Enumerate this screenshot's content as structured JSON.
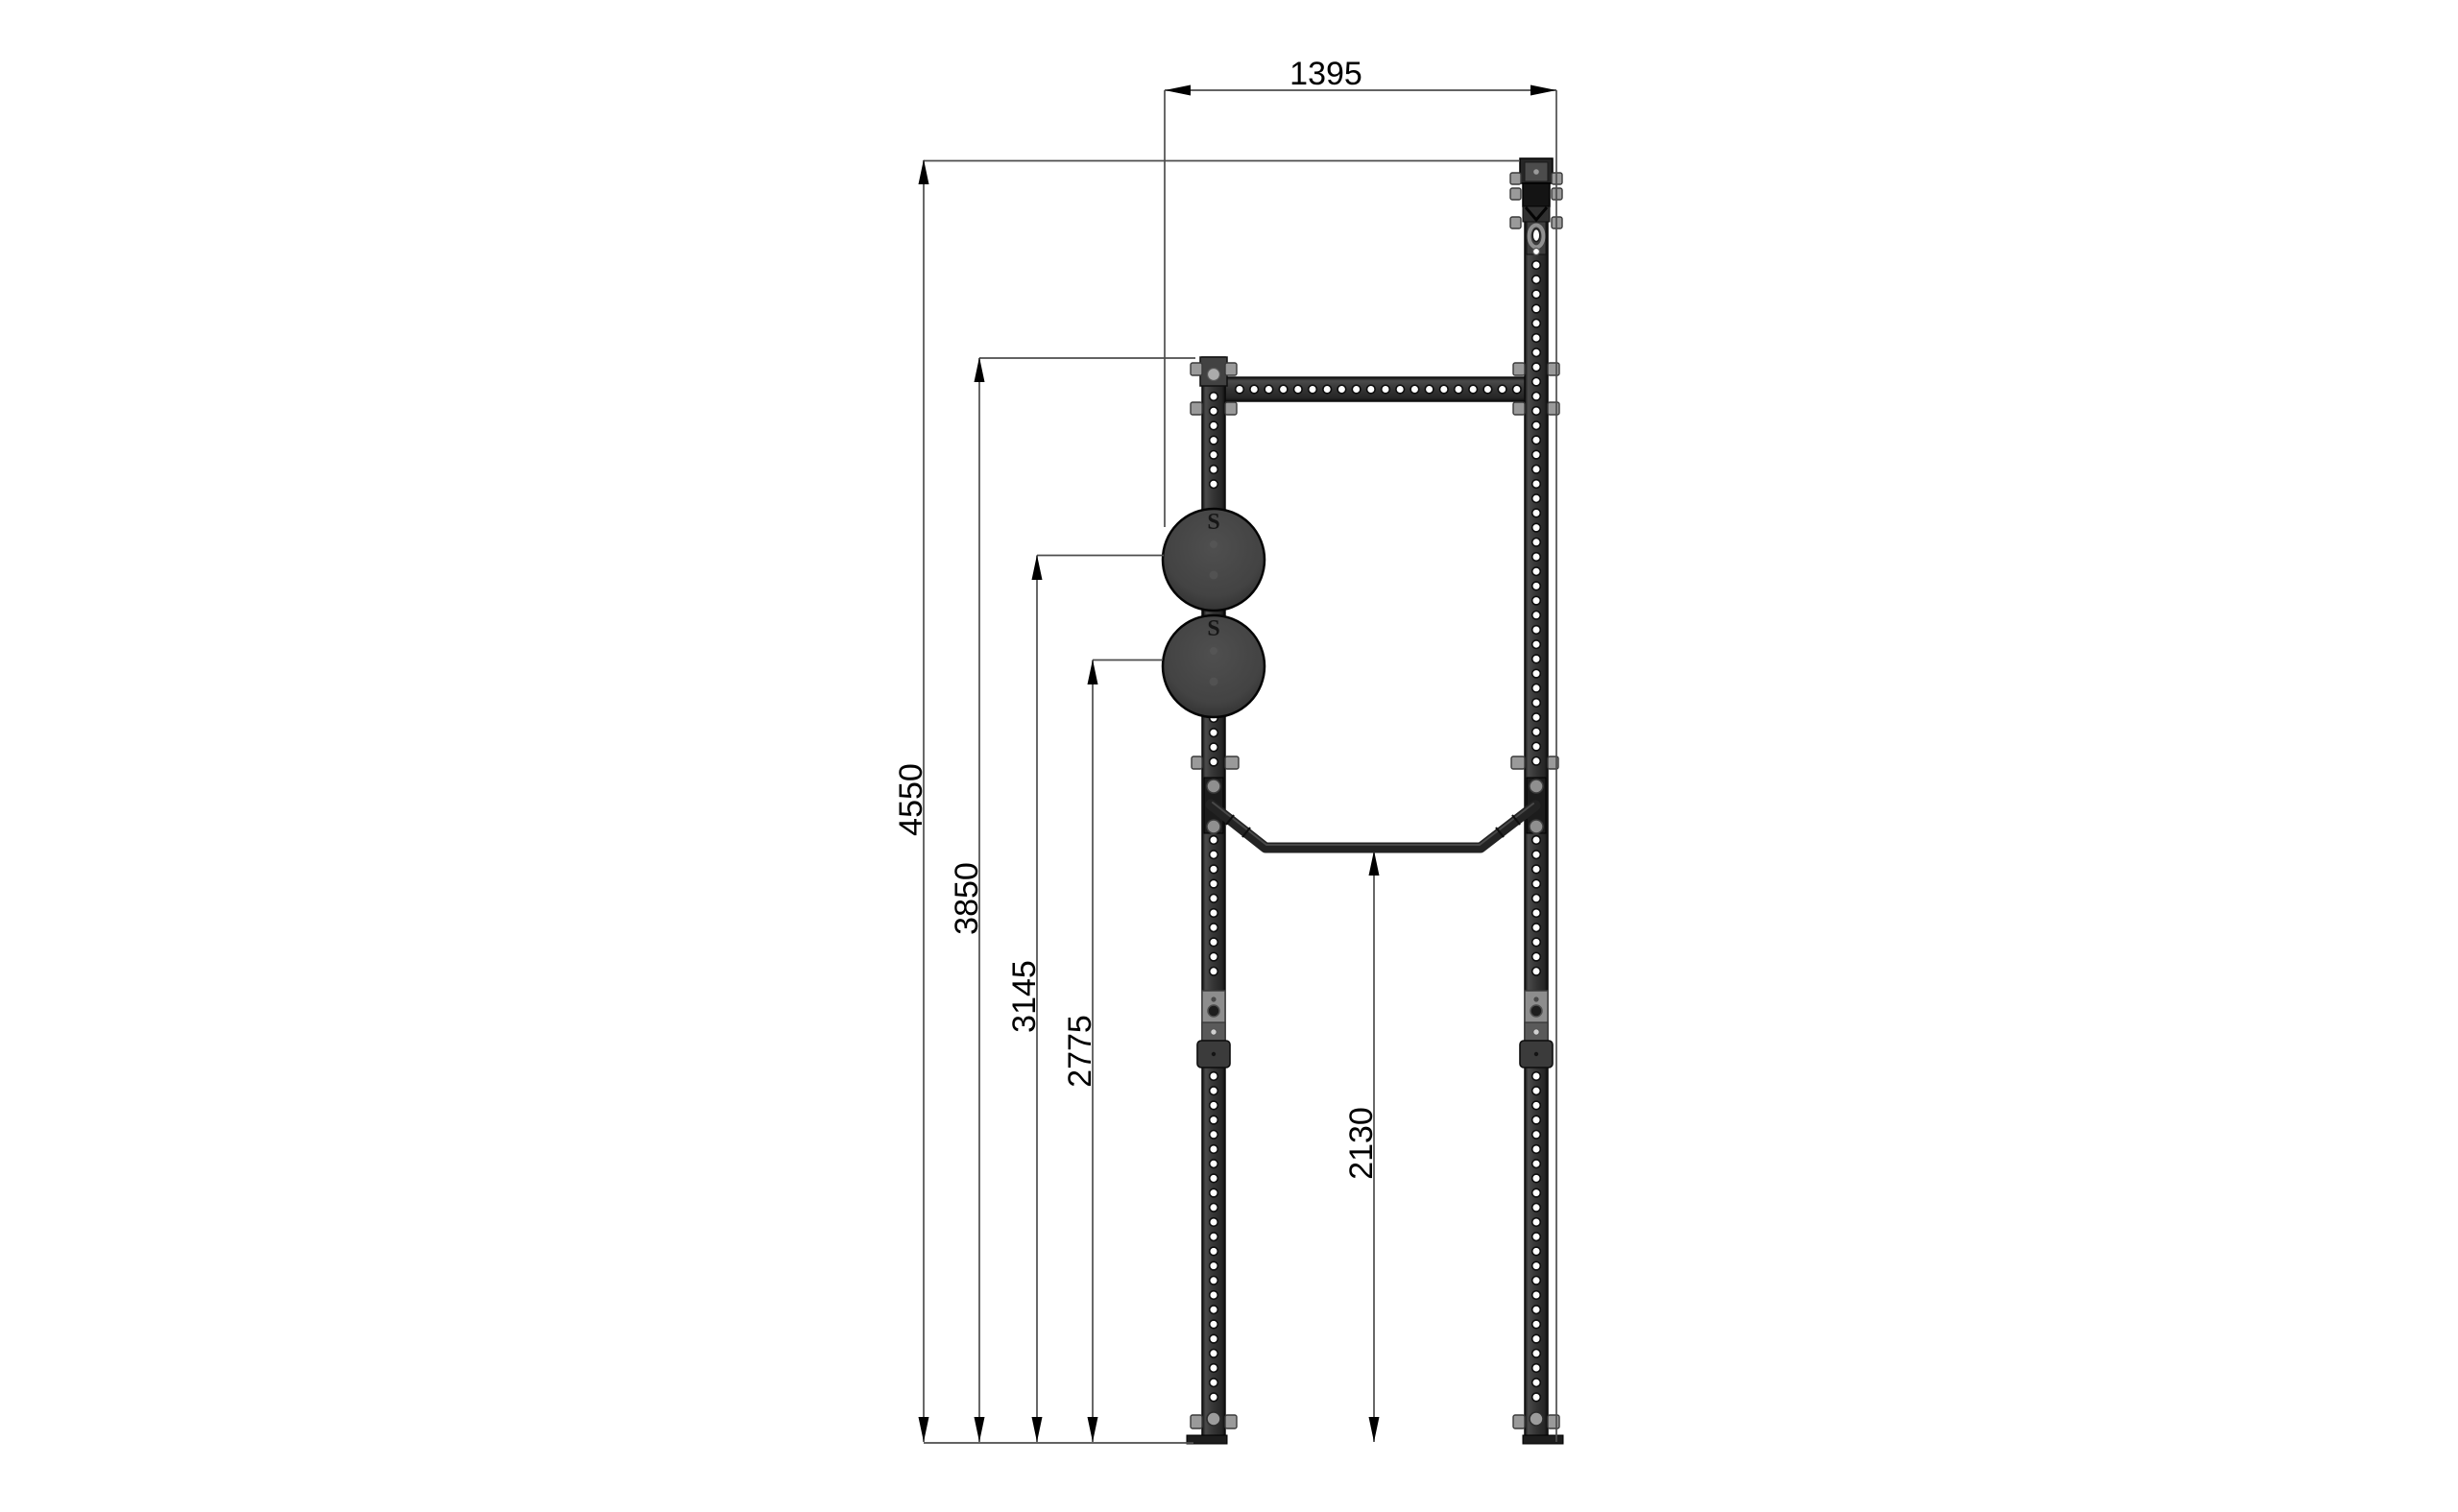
{
  "drawing": {
    "type": "technical-dimension-drawing",
    "subject": "free-standing rig side view with cannonball grips and pull-up bar",
    "background": "#ffffff",
    "colors": {
      "dimension_line": "#4d4d4d",
      "text": "#000000",
      "steel_dark": "#2e2e2e",
      "steel_light": "#8d8d8d",
      "ball_fill": "#454545",
      "hole_fill": "#ffffff"
    },
    "dimensions": {
      "overall_depth": {
        "value": "1395",
        "orientation": "horizontal"
      },
      "total_height": {
        "value": "4550",
        "orientation": "vertical"
      },
      "short_upright_height": {
        "value": "3850",
        "orientation": "vertical"
      },
      "upper_ball_height": {
        "value": "3145",
        "orientation": "vertical"
      },
      "lower_ball_height": {
        "value": "2775",
        "orientation": "vertical"
      },
      "pullup_bar_height": {
        "value": "2130",
        "orientation": "vertical"
      }
    },
    "ball_logo_glyph": "S"
  }
}
